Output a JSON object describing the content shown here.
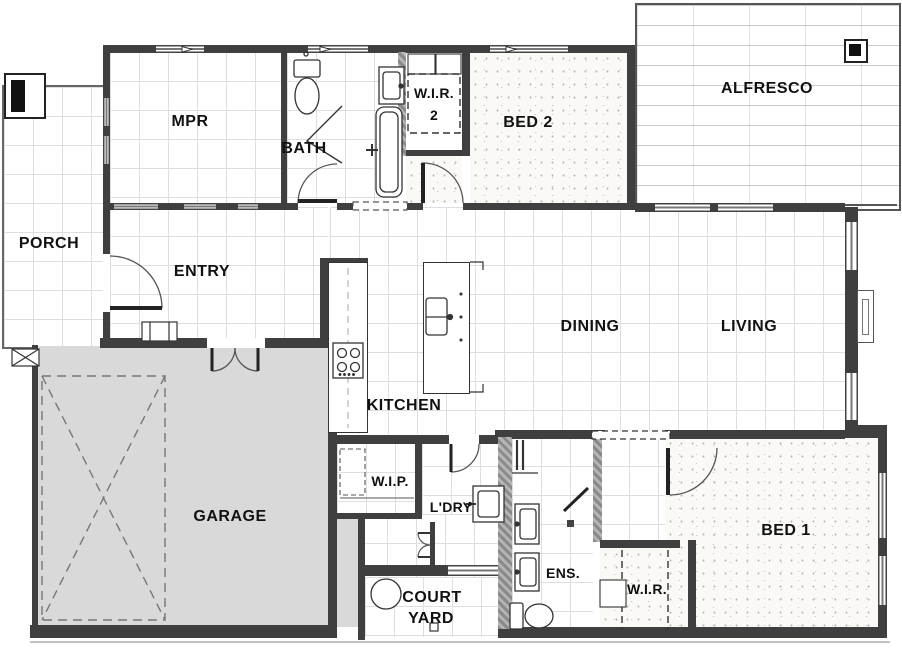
{
  "plan_title": "Single storey house floor plan",
  "rooms": {
    "porch": "PORCH",
    "mpr": "MPR",
    "bath": "BATH",
    "wir2_line1": "W.I.R.",
    "wir2_line2": "2",
    "bed2": "BED 2",
    "alfresco": "ALFRESCO",
    "entry": "ENTRY",
    "dining": "DINING",
    "living": "LIVING",
    "kitchen": "KITCHEN",
    "garage": "GARAGE",
    "wip": "W.I.P.",
    "ldry": "L'DRY",
    "ens": "ENS.",
    "wir": "W.I.R.",
    "bed1": "BED 1",
    "courtyard_line1": "COURT",
    "courtyard_line2": "YARD"
  },
  "colors": {
    "wall": "#3f3f3f",
    "wall_hatched": "#8a8a8a",
    "garage_fill": "#d9d9d9",
    "tile_grid_line": "#dedede",
    "carpet_base": "#faf9f6",
    "deck_line": "#c9c9c9",
    "outline": "#555555",
    "label_text": "#111111"
  }
}
